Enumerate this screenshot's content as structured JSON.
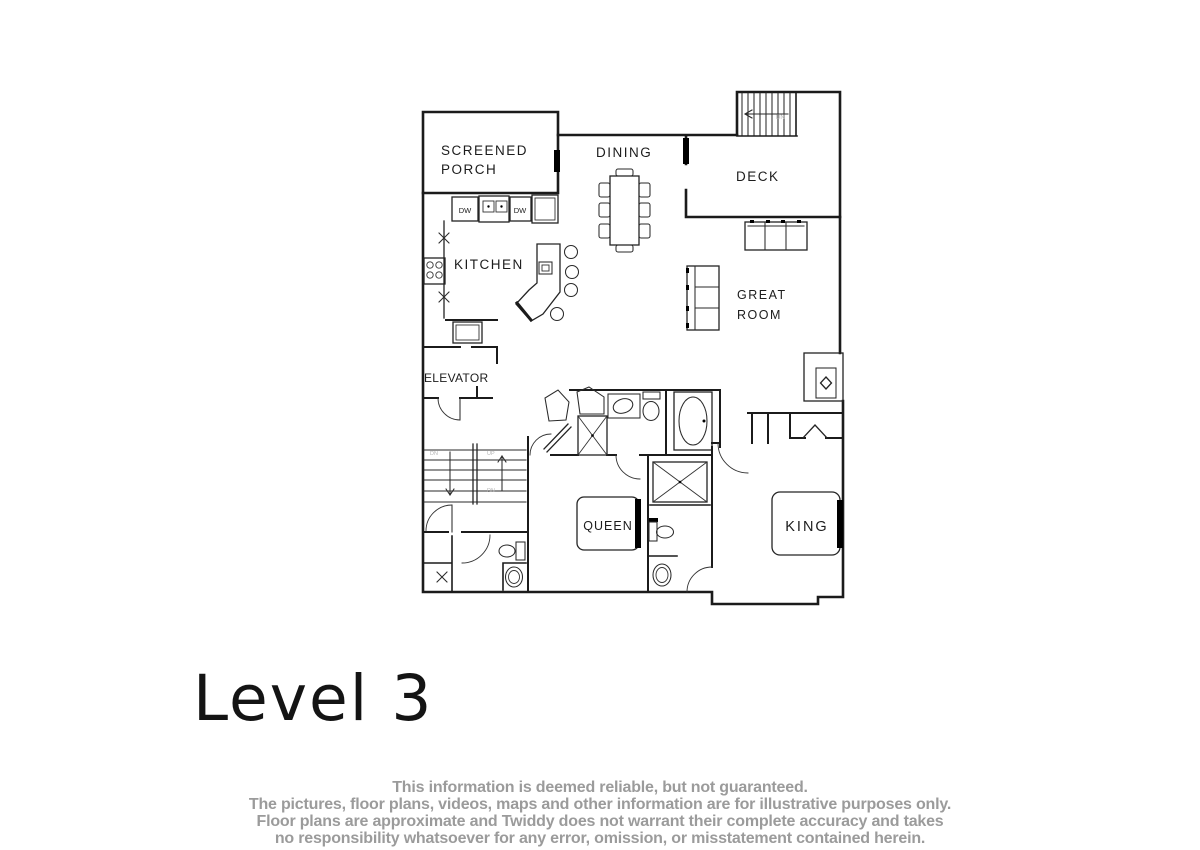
{
  "page": {
    "background": "#ffffff",
    "line_color": "#1b1b1b"
  },
  "plan": {
    "title": "Level 3",
    "labels": {
      "screened_porch_line1": "SCREENED",
      "screened_porch_line2": "PORCH",
      "dining": "DINING",
      "deck": "DECK",
      "kitchen": "KITCHEN",
      "great_room_line1": "GREAT",
      "great_room_line2": "ROOM",
      "elevator": "ELEVATOR",
      "queen": "QUEEN",
      "king": "KING",
      "dishwasher": "DW",
      "down": "DN",
      "up": "UP"
    }
  },
  "footer": {
    "text_color": "#9b9b9b",
    "disclaimer_lines": [
      "This information is deemed reliable, but not guaranteed.",
      "The pictures, floor plans, videos, maps and other information are for illustrative purposes only.",
      "Floor plans are approximate and Twiddy does not warrant their complete accuracy and takes",
      "no responsibility whatsoever for any error, omission, or misstatement contained herein."
    ]
  }
}
